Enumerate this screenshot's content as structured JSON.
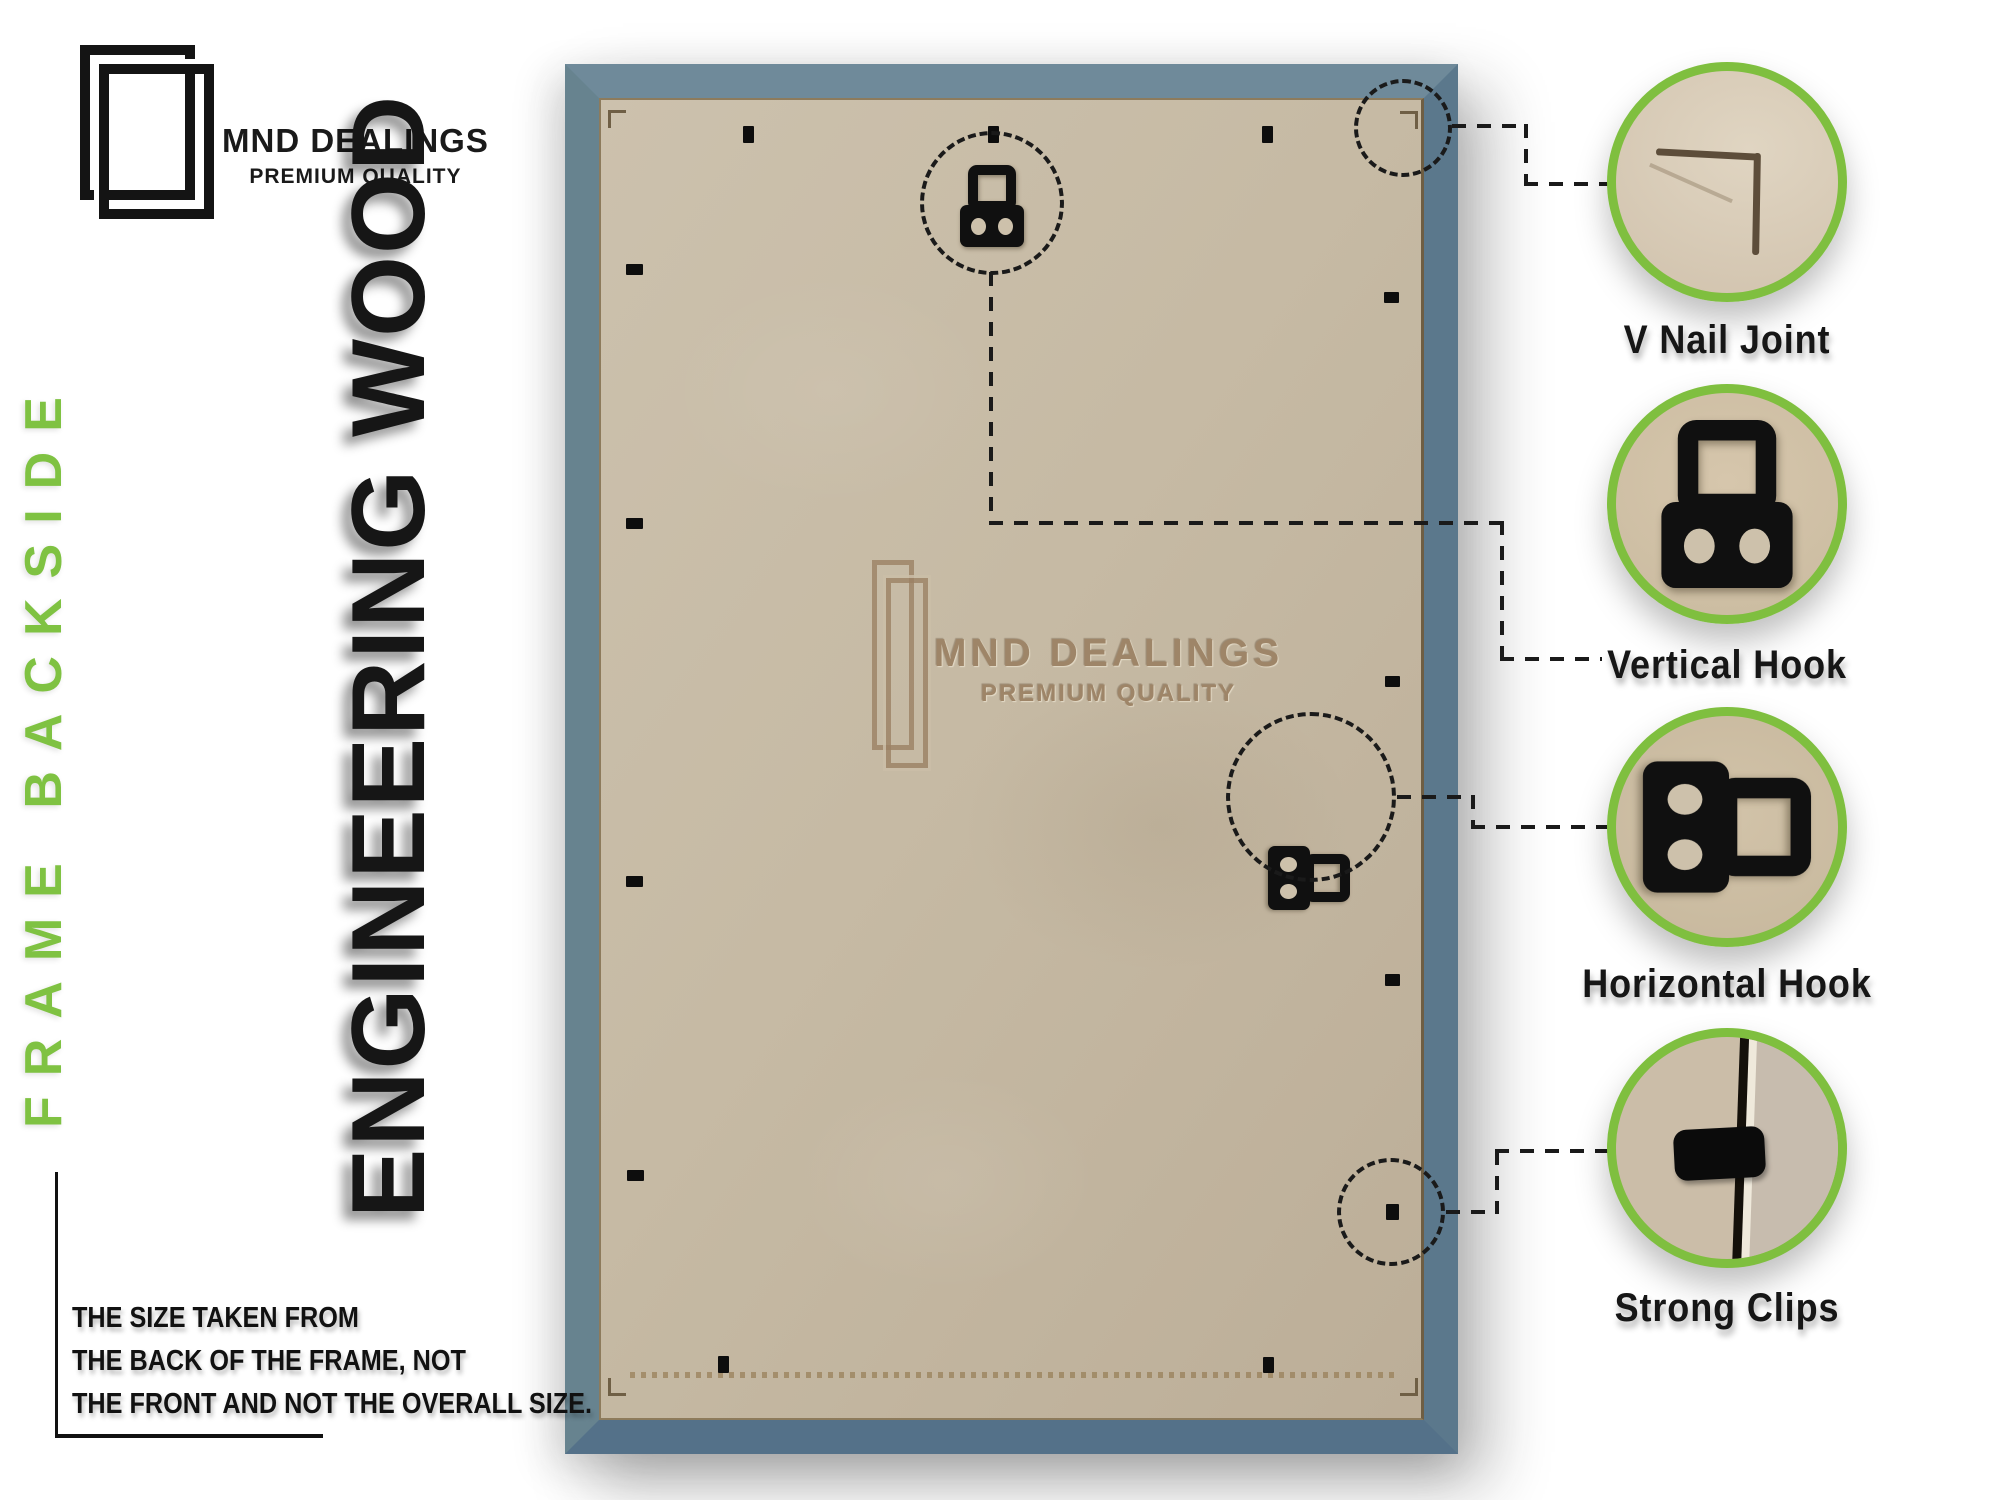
{
  "brand": {
    "name": "MND DEALINGS",
    "tagline": "PREMIUM QUALITY"
  },
  "side_labels": {
    "frame_backside": "FRAME BACKSIDE",
    "material": "ENGINEERING WOOD"
  },
  "watermark": {
    "name": "MND DEALINGS",
    "tagline": "PREMIUM QUALITY"
  },
  "callouts": [
    {
      "id": "v-nail-joint",
      "label": "V Nail Joint"
    },
    {
      "id": "vertical-hook",
      "label": "Vertical Hook"
    },
    {
      "id": "horizontal-hook",
      "label": "Horizontal Hook"
    },
    {
      "id": "strong-clips",
      "label": "Strong Clips"
    }
  ],
  "size_note": {
    "line1": "THE SIZE TAKEN FROM",
    "line2": "THE BACK OF THE FRAME, NOT",
    "line3": "THE FRONT AND NOT THE OVERALL SIZE."
  },
  "colors": {
    "accent_green": "#7fbf3f",
    "label_green": "#7fc242",
    "frame_blue": "#5e7b8e",
    "backing_tan": "#e9d8b6",
    "panel_mdf": "#c6baa4",
    "ink": "#141414"
  }
}
